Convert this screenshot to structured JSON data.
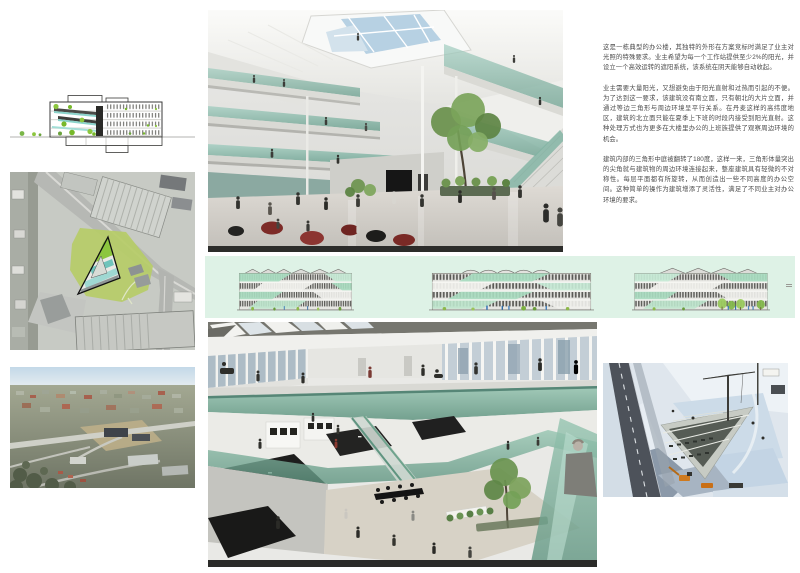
{
  "description": {
    "paragraphs": [
      "这是一栋典型的办公楼，其独特的外形在方案竞标时满足了业主对光照的特殊要求。业主希望为每一个工作站提供至少2%的阳光，并设立一个高效运转的遮阳系统，该系统在阴天能够自动收起。",
      "业主需要大量阳光，又想避免由于阳光直射和过热而引起的不便。为了达到这一要求，该建筑没有南立面，只有朝北的大片立面，并通过等边三角形与周边环境呈平行关系。在丹麦这样的高纬度地区，建筑的北立面只能在夏季上下班的时段内接受到阳光直射。这种处理方式也为更多在大楼里办公的上班族提供了观察周边环境的机会。",
      "建筑内部的三角形中庭被翻转了180度，这样一来，三角形体量突出的尖角就与建筑物的周边环境连接起来，整座建筑具有轻微的不对称性。每层平面都有所旋转，从而创造出一些不同高度的办公空间。这种简单的操作为建筑增添了灵活性，满足了不同业主对办公环境的要求。"
    ]
  },
  "colors": {
    "mint_strip_background": "#def2e6",
    "glass_green": "#7fb7a6",
    "site_highlight_green": "#b6cc67",
    "building_accent_green": "#8cc63e",
    "section_teal": "#7ecec4",
    "swan_chair_red": "#7d2b27"
  }
}
